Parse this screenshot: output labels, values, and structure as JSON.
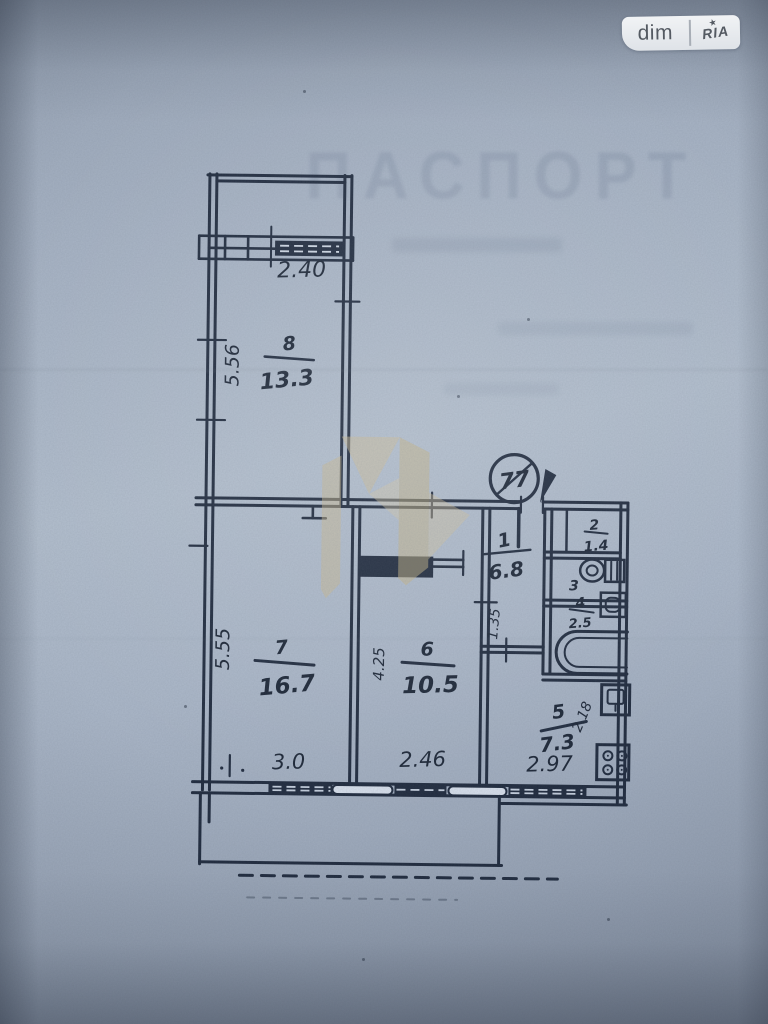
{
  "site_badge": {
    "left_label": "dim",
    "right_label": "RIA",
    "star_icon": "★"
  },
  "document": {
    "watermark_heading": "ПАСПОРТ"
  },
  "floor_plan": {
    "apartment_number": "77",
    "passage_width": "1.35",
    "ink_color": "#1f2a3d",
    "paper_color": "#aeb9c9",
    "rooms": [
      {
        "number": "8",
        "area": "13.3",
        "length": "5.56",
        "width": "2.40"
      },
      {
        "number": "7",
        "area": "16.7",
        "length": "5.55",
        "width": "3.0"
      },
      {
        "number": "6",
        "area": "10.5",
        "length": "4.25",
        "width": "2.46"
      },
      {
        "number": "5",
        "area": "7.3",
        "depth": "2.18",
        "width": "2.97"
      },
      {
        "number": "1",
        "area": "6.8"
      },
      {
        "number": "2",
        "area": "1.4"
      },
      {
        "number": "3"
      },
      {
        "number": "4",
        "area": "2.5"
      }
    ]
  }
}
